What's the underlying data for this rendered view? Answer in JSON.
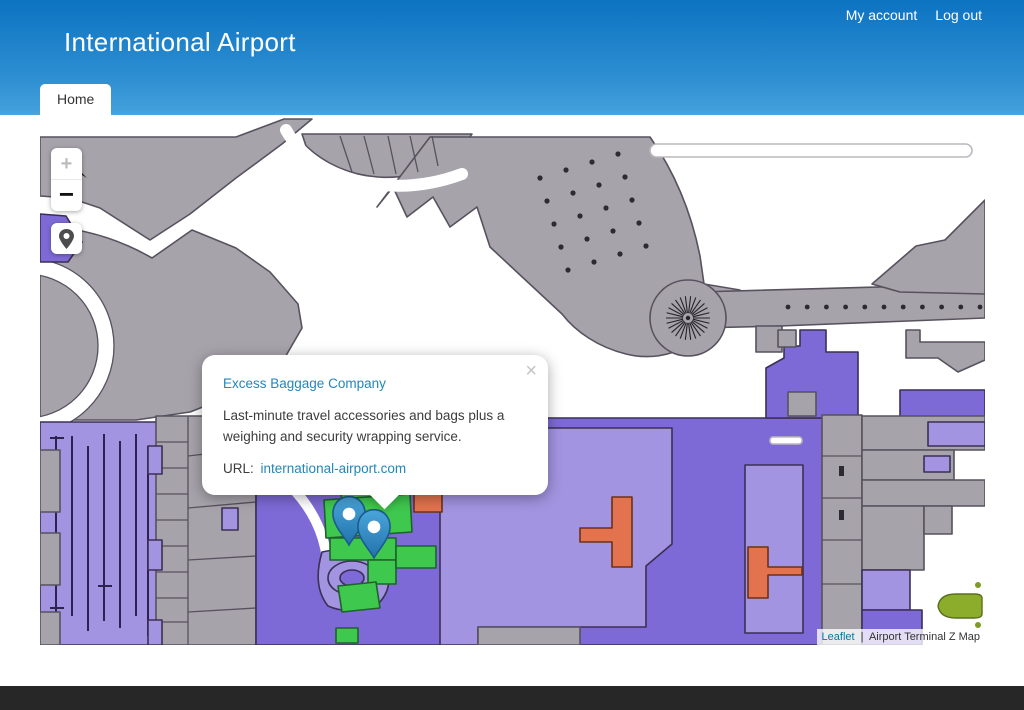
{
  "header": {
    "title": "International Airport",
    "nav": [
      {
        "label": "My account"
      },
      {
        "label": "Log out"
      }
    ],
    "tab": {
      "label": "Home"
    }
  },
  "map": {
    "controls": {
      "zoom_in": "+",
      "zoom_out": "−",
      "marker_button_icon": "location-pin-icon"
    },
    "popup": {
      "title": "Excess Baggage Company",
      "description": "Last-minute travel accessories and bags plus a weighing and security wrapping service.",
      "url_label": "URL:",
      "url": "international-airport.com",
      "close": "×"
    },
    "markers": [
      {
        "name": "excess-baggage-company-marker"
      },
      {
        "name": "nearby-location-marker"
      }
    ],
    "attribution": {
      "leaflet": "Leaflet",
      "separator": "|",
      "text": "Airport Terminal Z Map"
    }
  },
  "colors": {
    "header_gradient_top": "#0c73c2",
    "header_gradient_bottom": "#4aa6e0",
    "popup_link_blue": "#2486b9",
    "leaflet_link_blue": "#0078A8",
    "terminal_gray": "#a7a3ab",
    "zone_purple": "#7e6ad6",
    "zone_lavender": "#a294e0",
    "zone_green": "#3fc84e",
    "zone_orange": "#e2734e",
    "aircraft_olive": "#8cad2c",
    "marker_blue": "#3492cf",
    "footer_dark": "#272727"
  }
}
